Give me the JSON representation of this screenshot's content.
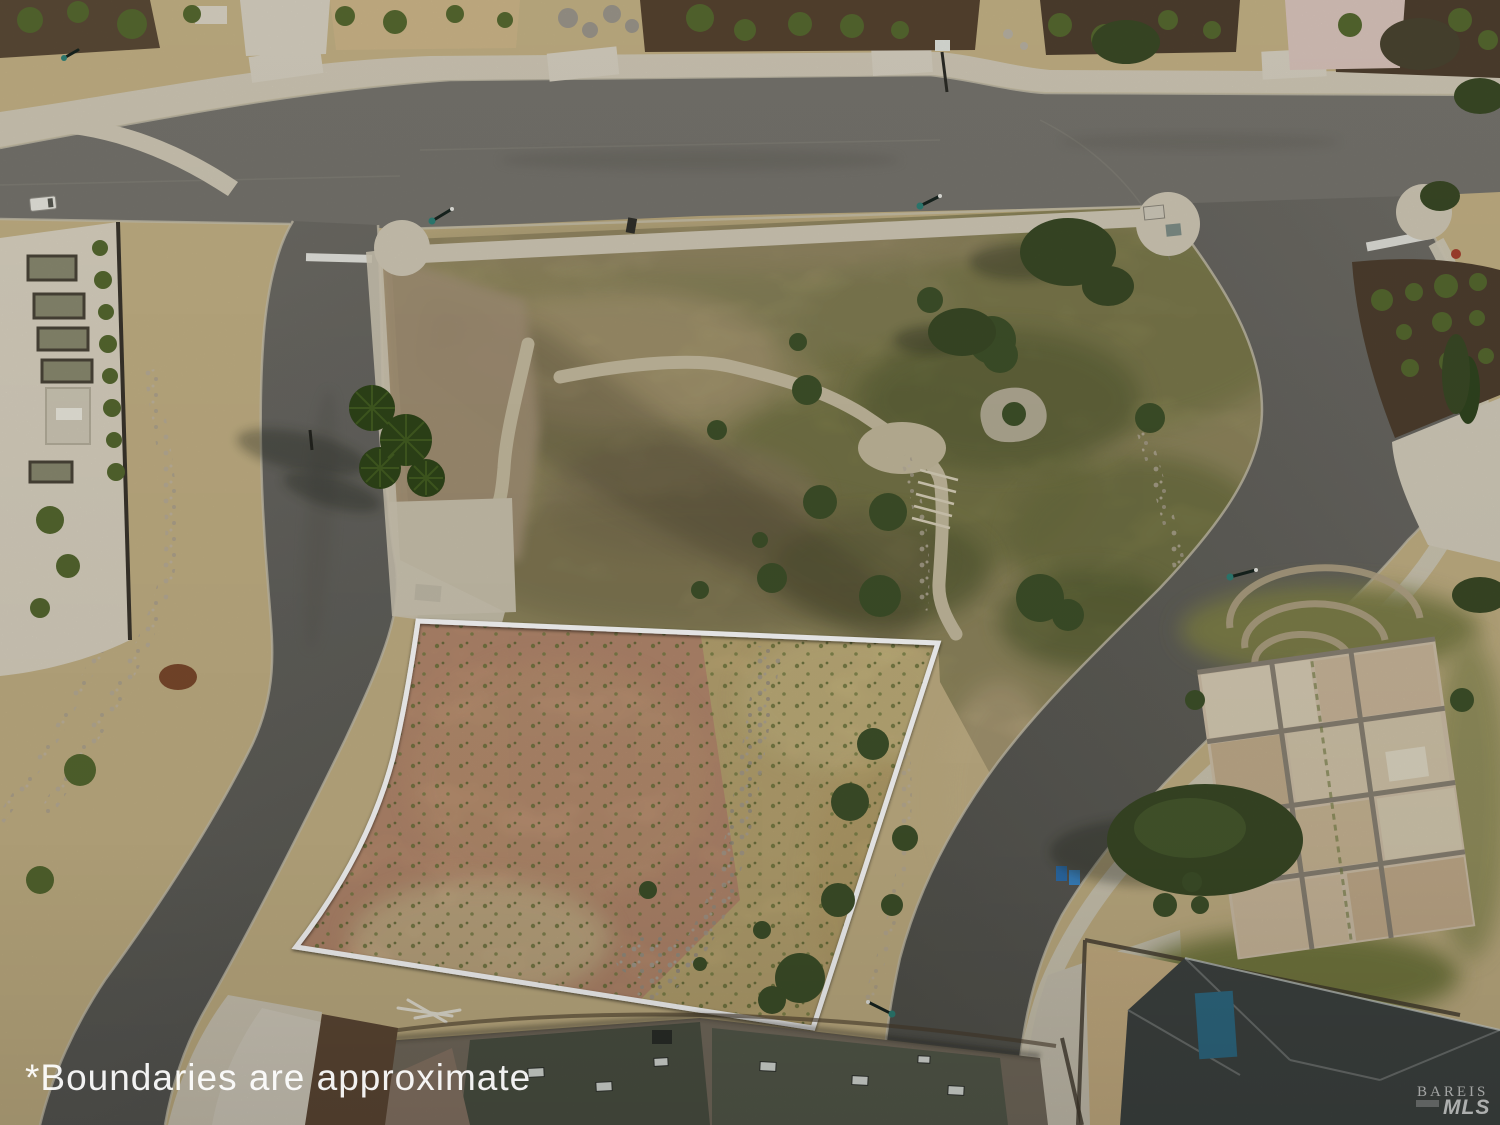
{
  "scene": {
    "type": "aerial drone photograph, top-down view",
    "subject": "vacant residential hillside lot outlined in white inside a subdivision with curving streets and open space",
    "landmarks": [
      "white approximate-boundary outline around bare dirt lot",
      "T-intersection of streets at top",
      "palm tree cluster beside left street",
      "gravel walking path winding through dry open space",
      "unfinished concrete foundation slabs at right",
      "new rooftops along bottom edge"
    ]
  },
  "overlay": {
    "disclaimer": "*Boundaries are approximate",
    "watermark": {
      "brand": "BAREIS",
      "sub": "MLS"
    }
  },
  "palette": {
    "boundary_white": "#ffffff",
    "asphalt": "#76746d",
    "asphalt_dark": "#56564f",
    "sidewalk_concrete": "#cfc8b5",
    "dry_grass": "#c2b084",
    "scrub_green": "#8b8a55",
    "scrub_dark_green": "#6e7342",
    "tree_green": "#3a4a26",
    "lot_dirt_pink": "#c9997a",
    "lot_dirt_tan": "#cdb77e",
    "bare_dirt": "#a39176",
    "pale_concrete": "#d6cfc0",
    "mulch_brown": "#55432f",
    "roof_gray_green": "#4d5244",
    "roof_brown": "#756c5e",
    "roof_charcoal": "#3f4442",
    "roof_teal_accent": "#2f6b84",
    "lamp_teal": "#2e8076"
  }
}
